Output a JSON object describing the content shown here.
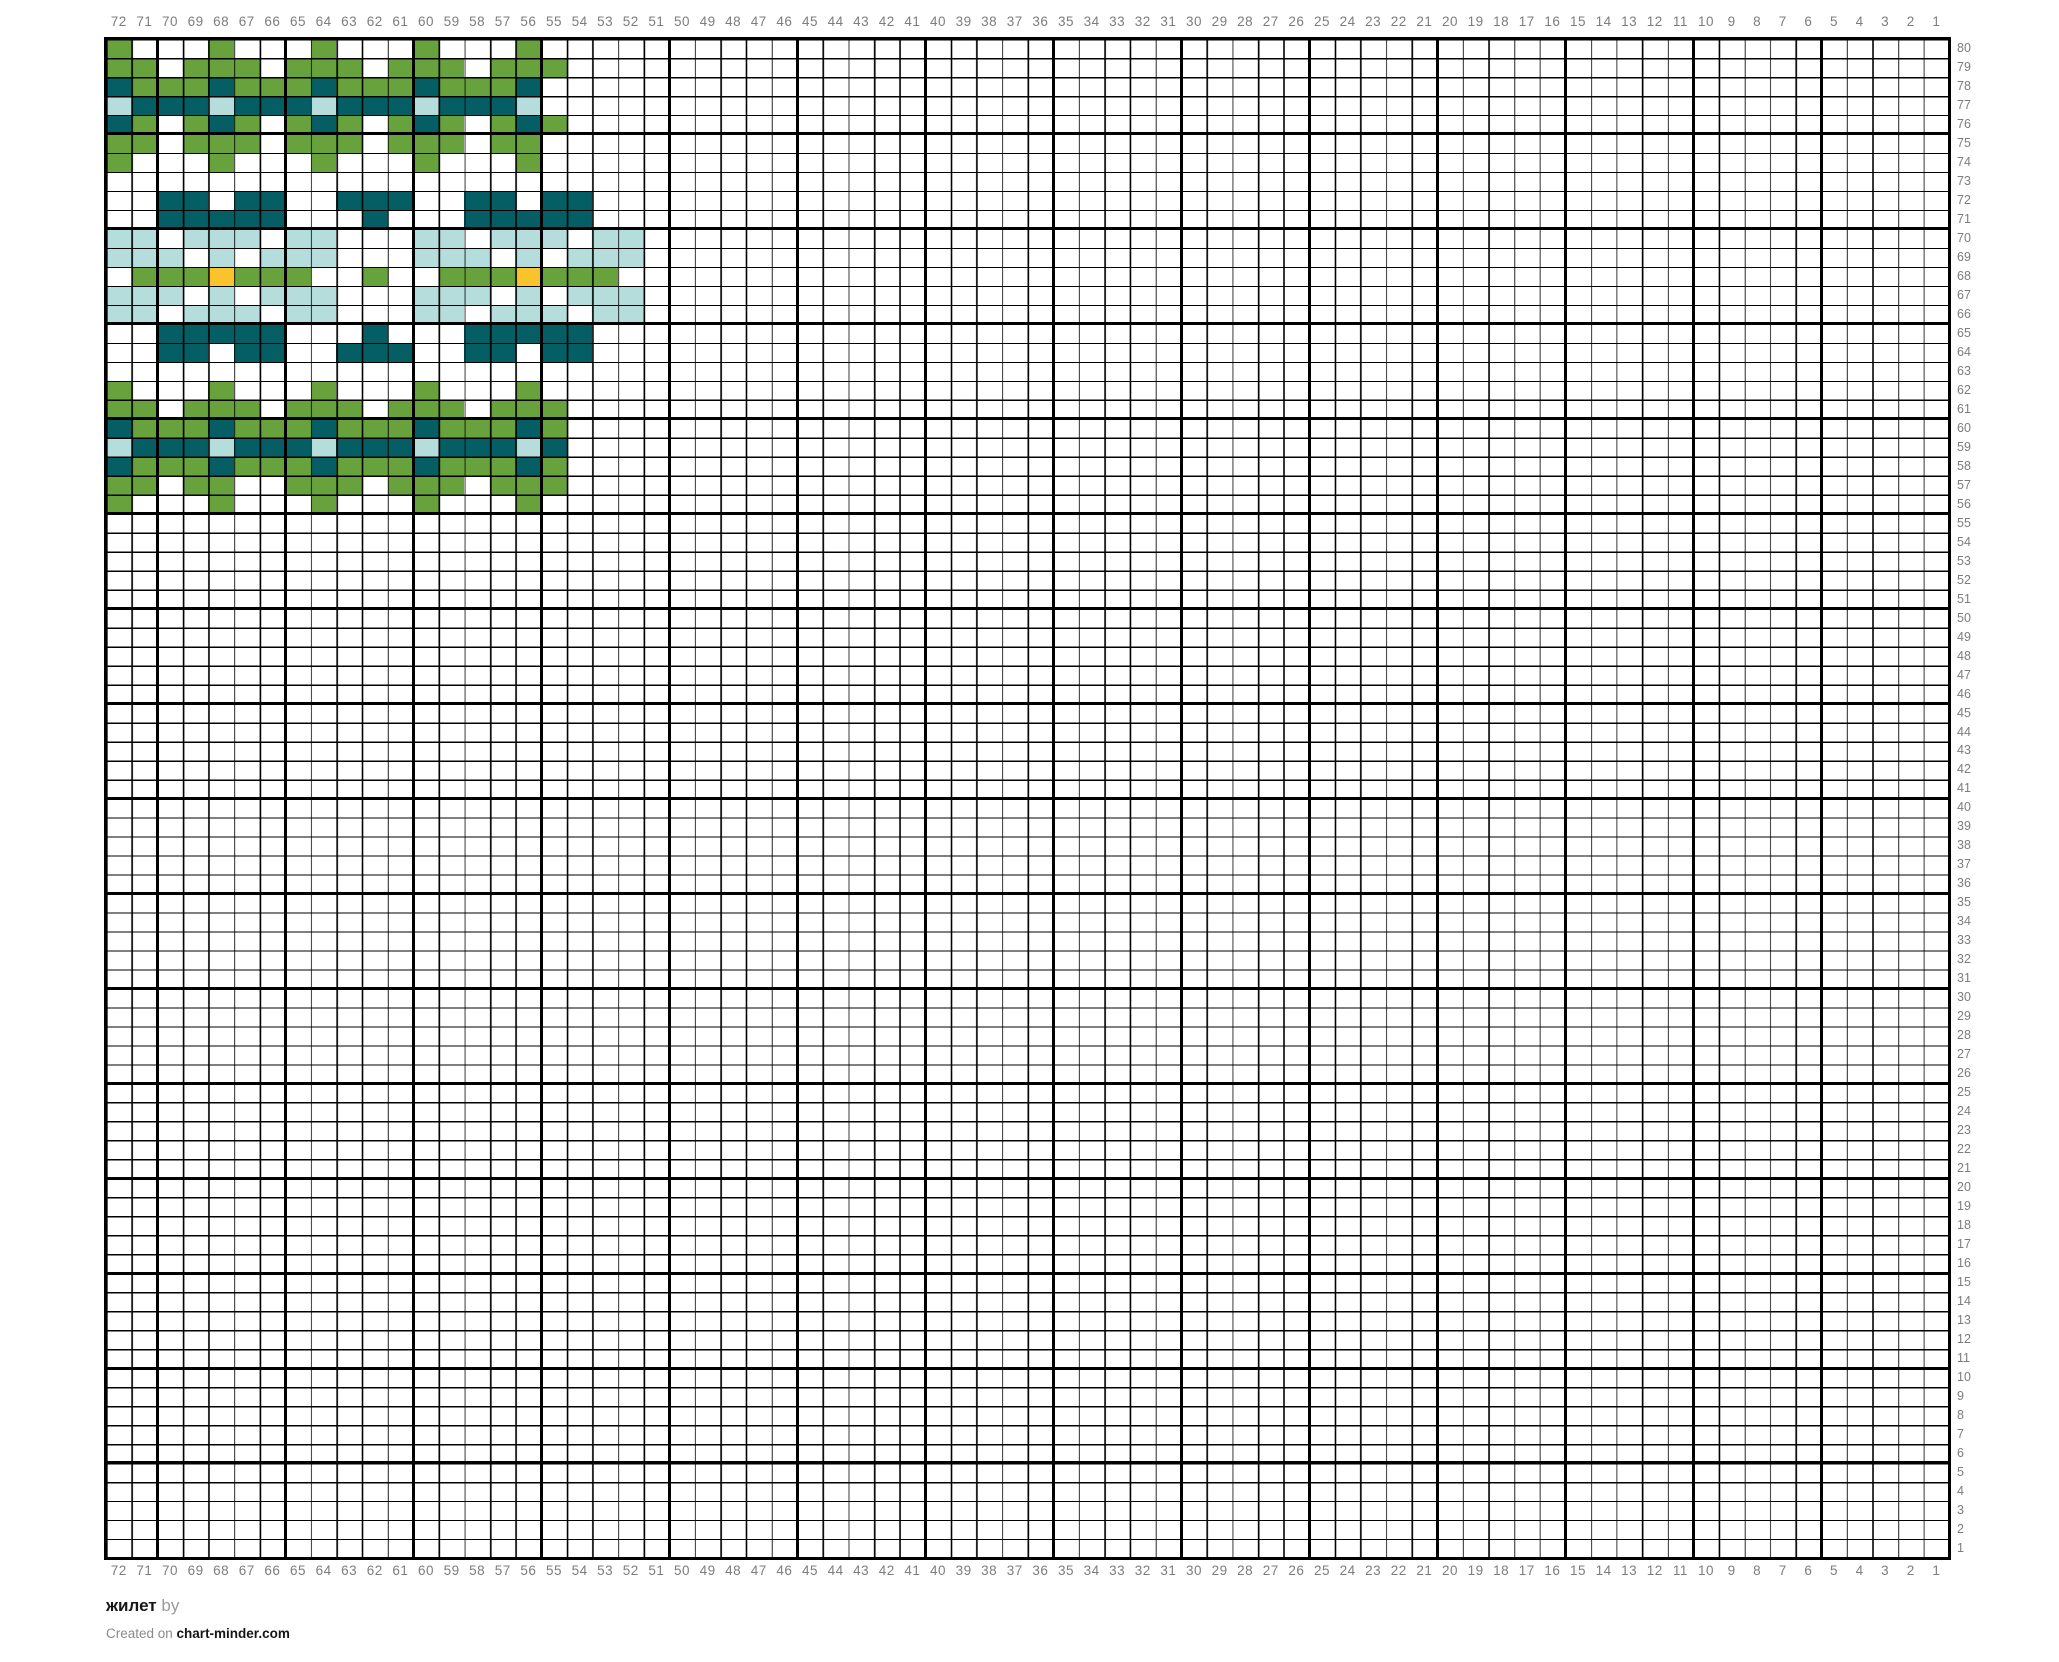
{
  "chart_data": {
    "type": "heatmap",
    "title": "жилет",
    "description": "Knitting colorwork chart grid, 72 stitches x 80 rows, motif drawn in top-left corner",
    "columns": 72,
    "rows": 80,
    "column_labels": [
      72,
      71,
      70,
      69,
      68,
      67,
      66,
      65,
      64,
      63,
      62,
      61,
      60,
      59,
      58,
      57,
      56,
      55,
      54,
      53,
      52,
      51,
      50,
      49,
      48,
      47,
      46,
      45,
      44,
      43,
      42,
      41,
      40,
      39,
      38,
      37,
      36,
      35,
      34,
      33,
      32,
      31,
      30,
      29,
      28,
      27,
      26,
      25,
      24,
      23,
      22,
      21,
      20,
      19,
      18,
      17,
      16,
      15,
      14,
      13,
      12,
      11,
      10,
      9,
      8,
      7,
      6,
      5,
      4,
      3,
      2,
      1
    ],
    "row_labels": [
      80,
      79,
      78,
      77,
      76,
      75,
      74,
      73,
      72,
      71,
      70,
      69,
      68,
      67,
      66,
      65,
      64,
      63,
      62,
      61,
      60,
      59,
      58,
      57,
      56,
      55,
      54,
      53,
      52,
      51,
      50,
      49,
      48,
      47,
      46,
      45,
      44,
      43,
      42,
      41,
      40,
      39,
      38,
      37,
      36,
      35,
      34,
      33,
      32,
      31,
      30,
      29,
      28,
      27,
      26,
      25,
      24,
      23,
      22,
      21,
      20,
      19,
      18,
      17,
      16,
      15,
      14,
      13,
      12,
      11,
      10,
      9,
      8,
      7,
      6,
      5,
      4,
      3,
      2,
      1
    ],
    "palette": {
      "G": "#68a23c",
      "T": "#045e63",
      "L": "#b5dddc",
      "O": "#f9c32b",
      ".": "#ffffff"
    },
    "grid_lines": {
      "thin_color": "#000000",
      "bold_color": "#000000",
      "bold_every": 5
    },
    "pattern": {
      "start_row": 80,
      "start_col": 72,
      "legend": "Each string is one row, chars map columns 72 down to 51; G=green, T=teal, L=light blue, O=orange, .=white; all cells outside these rows/columns are white",
      "rows": [
        "G...G...G...G...G.....",
        "GG.GGG.GGG.GGG.GGG....",
        "TGGGTGGGTGGGTGGGT.....",
        "LTTTLTTTLTTTLTTTL.....",
        "TG.GTG.GTG.GTG.GTG....",
        "GG.GGG.GGG.GGG.GG.....",
        "G...G...G...G...G.....",
        "......................",
        "..TT.TT..TTT..TT.TT...",
        "..TTTTT...T...TTTTT...",
        "LL.LLL.LL...LL.LLL.LL.",
        "LLL.L.LLL...LLL.L.LLL.",
        ".GGGOGGG..G..GGGOGGG..",
        "LLL.L.LLL...LLL.L.LLL.",
        "LL.LLL.LL...LL.LLL.LL.",
        "..TTTTT...T...TTTTT...",
        "..TT.TT..TTT..TT.TT...",
        "......................",
        "G...G...G...G...G.....",
        "GG.GGG.GGG.GGG.GGG....",
        "TGGGTGGGTGGGTGGGTG....",
        "LTTTLTTTLTTTLTTTLT....",
        "TGGGTGGGTGGGTGGGTG....",
        "GG.GG..GGG.GGG.GGG....",
        "G...G...G...G...G....."
      ]
    }
  },
  "footer": {
    "title": "жилет",
    "byline": " by",
    "credit_prefix": "Created on ",
    "credit_site": "chart-minder.com"
  }
}
